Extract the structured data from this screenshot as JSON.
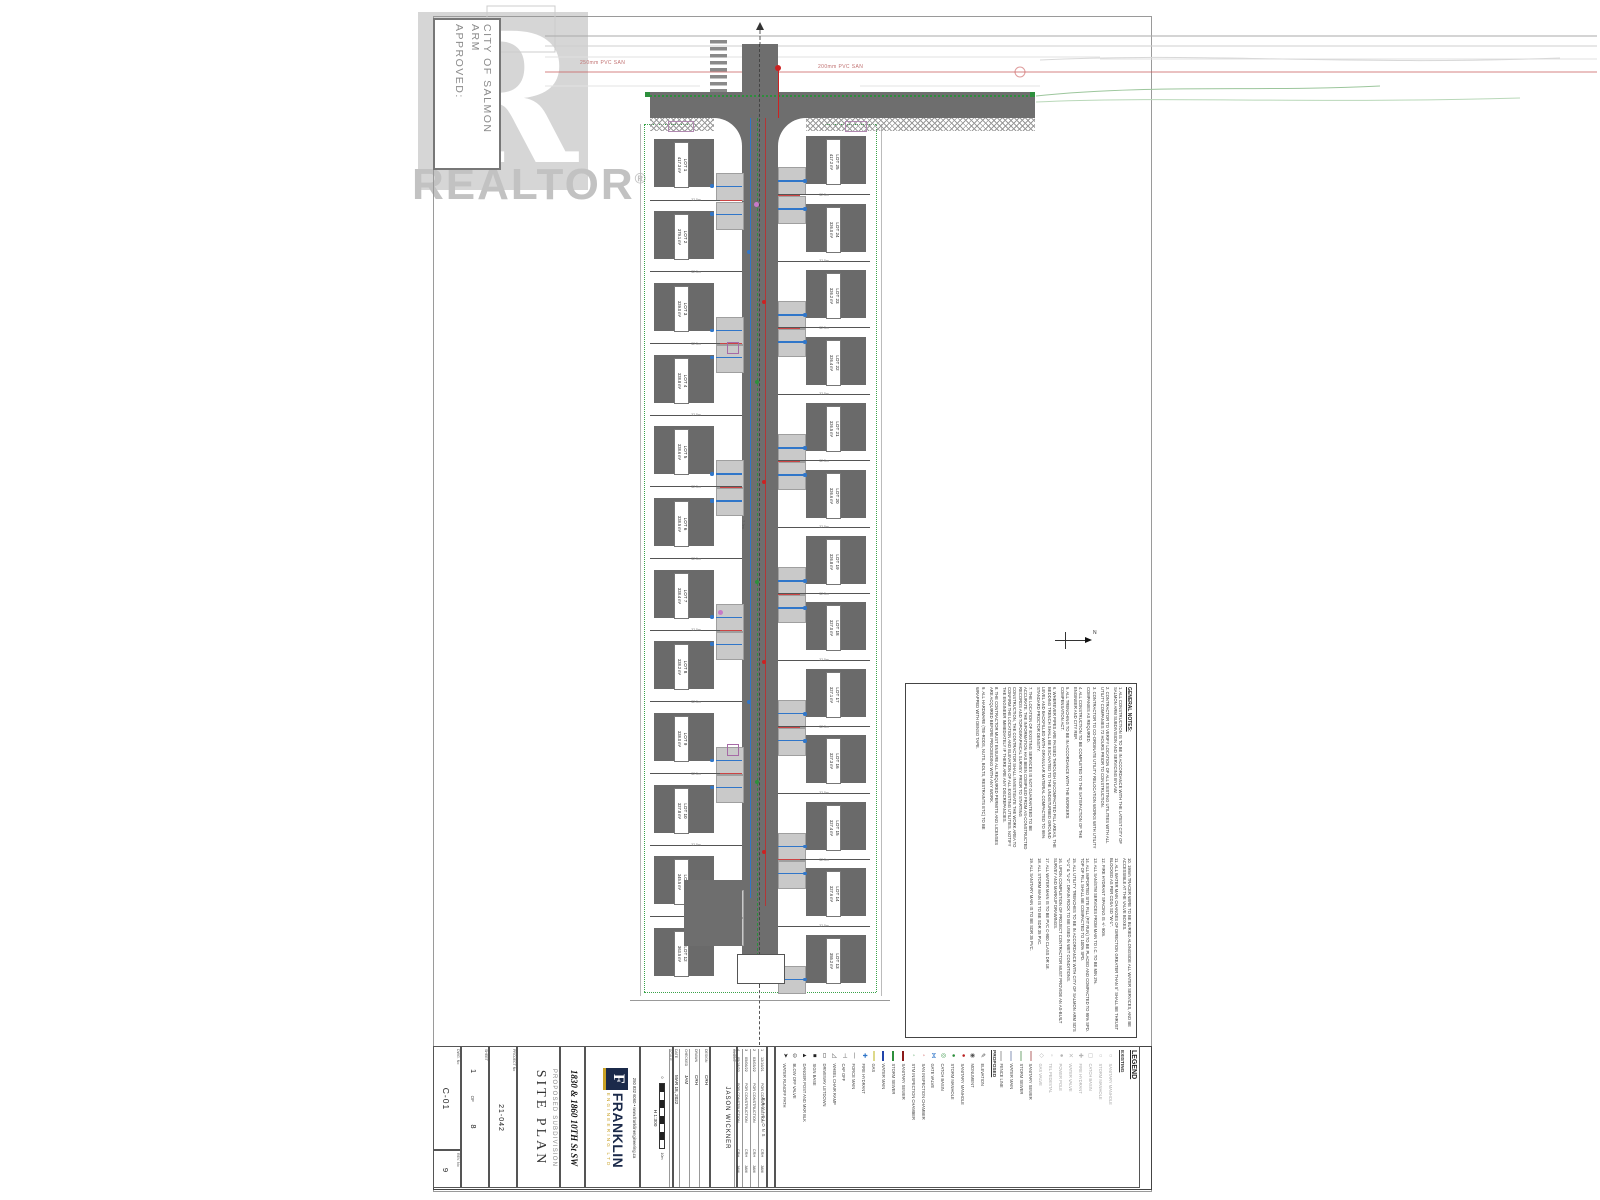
{
  "watermark": {
    "logo_letter": "R",
    "brand": "REALTOR",
    "reg": "®"
  },
  "stamp": {
    "line1": "CITY OF SALMON ARM",
    "line2": "APPROVED:"
  },
  "top_road": {
    "left_pipe_label": "250mm PVC SAN",
    "right_pipe_label": "200mm PVC SAN"
  },
  "road": {
    "width_label": "7.3m"
  },
  "north": {
    "label": "N"
  },
  "lots": {
    "left": [
      {
        "id": "LOT 1",
        "area": "417.3 m²",
        "dim": "32.5m"
      },
      {
        "id": "LOT 2",
        "area": "379.1 m²",
        "dim": "32.5m"
      },
      {
        "id": "LOT 3",
        "area": "329.0 m²",
        "dim": "32.5m"
      },
      {
        "id": "LOT 4",
        "area": "328.8 m²",
        "dim": "32.5m"
      },
      {
        "id": "LOT 5",
        "area": "328.6 m²",
        "dim": "32.5m"
      },
      {
        "id": "LOT 6",
        "area": "328.5 m²",
        "dim": "32.5m"
      },
      {
        "id": "LOT 7",
        "area": "328.4 m²",
        "dim": "32.5m"
      },
      {
        "id": "LOT 8",
        "area": "328.2 m²",
        "dim": "32.5m"
      },
      {
        "id": "LOT 9",
        "area": "328.0 m²",
        "dim": "32.5m"
      },
      {
        "id": "LOT 10",
        "area": "327.8 m²",
        "dim": "32.5m"
      },
      {
        "id": "LOT 11",
        "area": "345.5 m²",
        "dim": "32.5m"
      },
      {
        "id": "LOT 12",
        "area": "363.5 m²",
        "dim": "32.5m"
      }
    ],
    "right": [
      {
        "id": "LOT 25",
        "area": "417.2 m²",
        "dim": "32.5m"
      },
      {
        "id": "LOT 24",
        "area": "326.0 m²",
        "dim": "32.5m"
      },
      {
        "id": "LOT 23",
        "area": "326.2 m²",
        "dim": "32.5m"
      },
      {
        "id": "LOT 22",
        "area": "326.4 m²",
        "dim": "32.5m"
      },
      {
        "id": "LOT 21",
        "area": "326.5 m²",
        "dim": "32.5m"
      },
      {
        "id": "LOT 20",
        "area": "326.6 m²",
        "dim": "32.5m"
      },
      {
        "id": "LOT 19",
        "area": "326.8 m²",
        "dim": "32.5m"
      },
      {
        "id": "LOT 18",
        "area": "327.0 m²",
        "dim": "32.5m"
      },
      {
        "id": "LOT 17",
        "area": "327.1 m²",
        "dim": "32.5m"
      },
      {
        "id": "LOT 16",
        "area": "327.3 m²",
        "dim": "32.5m"
      },
      {
        "id": "LOT 15",
        "area": "327.4 m²",
        "dim": "32.5m"
      },
      {
        "id": "LOT 14",
        "area": "327.6 m²",
        "dim": "32.5m"
      },
      {
        "id": "LOT 13",
        "area": "355.2 m²",
        "dim": "32.5m"
      }
    ]
  },
  "notes": {
    "title": "GENERAL NOTES:",
    "column1": [
      "1. ALL CONSTRUCTION IS TO BE IN ACCORDANCE WITH THE LATEST CITY OF SALMON ARM SUBDIVISION AND SERVICING BYLAW.",
      "2. CONTRACTOR TO VERIFY LOCATION OF ALL EXISTING UTILITIES WITH ALL UTILITY COMPANIES 72 HOURS PRIOR TO CONSTRUCTION.",
      "3. CONTRACTOR TO CO-ORDINATE UTILITY RELOCATION WORKS WITH UTILITY COMPANIES AS REQUIRED.",
      "4. ALL CONSTRUCTION TO BE COMPLETED TO THE SATISFACTION OF THE ENGINEER AND CITY REP.",
      "5. ALL TRENCHING TO BE IN ACCORDANCE WITH THE WORKERS COMPENSATION ACT.",
      "6. WHEREVER PIPES ARE PASSED THROUGH UNCOMPACTED FILL AREAS, THE BEDDING TRENCH SHALL BE EXCAVATED TO THE UNDISTURBED GROUND LEVEL AND BACKFILLED WITH GRANULAR MATERIAL COMPACTED TO 95% STANDARD PROCTOR DENSITY.",
      "7. THE LOCATION OF EXISTING SERVICES IS NOT GUARANTEED TO BE ACCURATE. THE INFORMATION HAS BEEN COMPILED FROM AS-CONSTRUCTED RECORDS AND TOPOGRAPHICAL SURVEY. PRIOR TO STARTING CONSTRUCTION, THE CONTRACTOR SHALL INVESTIGATE THE WORK AREA TO CONFIRM THE LOCATION AND ELEVATION OF ALL EXISTING UTILITIES. NOTIFY THE ENGINEER IMMEDIATELY IF THERE ARE ANY DISCREPANCIES.",
      "8. THE CONTRACTOR MUST ENSURE ALL REQUIRED PERMITS AND LICENSES ARE ACQUIRED BEFORE PROCEEDING WITH ANY WORK.",
      "9. ALL HARDWARE (TIE-RODS, NUTS, BOLTS, RESTRAINTS ETC) TO BE WRAPPED WITH DENSO TAPE."
    ],
    "column2": [
      "10. 19mm TRACER WIRE TO BE BURIED ALONGSIDE ALL WATER SERVICES, AND BE ACCESSIBLE AT THE VALVE BOXES.",
      "11. ALL WATER MAIN CHANGES OF DIRECTION GREATER THAN 5° SHALL BE THRUST BLOCKED AS PER CDSA SD \"W-1\".",
      "12. FIRE HYDRANT SPACING IS +/- 90m.",
      "13. ALL SAN/STM SERVICES FROM MAIN TO I.C. TO BE MIN 2%.",
      "14. ALL IMPORTED SITE FILL (PIT RUN) TO BE PLACED AND COMPACTED TO 95% SPD. TOP OF FILL SHALL BE COMPACTED TO 100% SPD.",
      "15. ALL UTILITY TRENCHES TO BE IN ACCORDANCE WITH CITY OF SALMON ARM SD'S \"U-1\" & \"U-2\". DRAIN ROCK TO BE USED IN WET CONDITIONS.",
      "16. UPON COMPLETION OF PROJECT CONTRACTOR MUST PROVIDE AN AS-BUILT SURVEY AND MARKUP DRAWINGS.",
      "17. ALL WATER MAIN IS TO BE PVC C-900 CLASS DR 18.",
      "18. ALL STORM MAIN IS TO BE SDR 35 PVC.",
      "19. ALL SANITARY MAIN IS TO BE SDR 35 PVC."
    ]
  },
  "legend": {
    "items": [
      {
        "kind": "title",
        "label": "LEGEND"
      },
      {
        "kind": "header",
        "label": "EXISTING"
      },
      {
        "kind": "item",
        "label": "SANITARY MANHOLE",
        "glyph": "○",
        "color": "#b5b5b5"
      },
      {
        "kind": "item",
        "label": "STORM MANHOLE",
        "glyph": "○",
        "color": "#b5b5b5"
      },
      {
        "kind": "item",
        "label": "CATCH BASIN",
        "glyph": "◻",
        "color": "#b5b5b5"
      },
      {
        "kind": "item",
        "label": "FIRE HYDRANT",
        "glyph": "✚",
        "color": "#b5b5b5"
      },
      {
        "kind": "item",
        "label": "WATER VALVE",
        "glyph": "✕",
        "color": "#b5b5b5"
      },
      {
        "kind": "item",
        "label": "POWER POLE",
        "glyph": "●",
        "color": "#b5b5b5"
      },
      {
        "kind": "item",
        "label": "TEL PEDESTAL",
        "glyph": "▫",
        "color": "#b5b5b5"
      },
      {
        "kind": "item",
        "label": "GAS VALVE",
        "glyph": "◇",
        "color": "#b5b5b5"
      },
      {
        "kind": "line",
        "label": "SANITARY SEWER",
        "color": "#d8b2b2"
      },
      {
        "kind": "line",
        "label": "STORM SEWER",
        "color": "#b9d2b9"
      },
      {
        "kind": "line",
        "label": "WATER MAIN",
        "color": "#c2c9da"
      },
      {
        "kind": "line",
        "label": "FENCE LINE",
        "color": "#cccccc"
      },
      {
        "kind": "header",
        "label": "PROPOSED"
      },
      {
        "kind": "item",
        "label": "ELEVATION",
        "glyph": "✎",
        "color": "#555555"
      },
      {
        "kind": "item",
        "label": "MONUMENT",
        "glyph": "◉",
        "color": "#555555"
      },
      {
        "kind": "item",
        "label": "SANITARY MANHOLE",
        "glyph": "●",
        "color": "#bb2222"
      },
      {
        "kind": "item",
        "label": "STORM MANHOLE",
        "glyph": "●",
        "color": "#2d8f3c"
      },
      {
        "kind": "item",
        "label": "CATCH BASIN",
        "glyph": "◎",
        "color": "#2d8f3c"
      },
      {
        "kind": "item",
        "label": "GATE VALVE",
        "glyph": "⋈",
        "color": "#3076c9"
      },
      {
        "kind": "item",
        "label": "SAN INSPECTION CHAMBER",
        "glyph": "◦",
        "color": "#bb2222"
      },
      {
        "kind": "item",
        "label": "STM INSPECTION CHAMBER",
        "glyph": "◦",
        "color": "#2d8f3c"
      },
      {
        "kind": "line",
        "label": "SANITARY SEWER",
        "color": "#8b1a1a"
      },
      {
        "kind": "line",
        "label": "STORM SEWER",
        "color": "#2d8f3c"
      },
      {
        "kind": "line",
        "label": "WATER MAIN",
        "color": "#2244aa"
      },
      {
        "kind": "line",
        "label": "GAS",
        "color": "#ddd98a"
      },
      {
        "kind": "item",
        "label": "FIRE HYDRANT",
        "glyph": "✚",
        "color": "#3076c9"
      },
      {
        "kind": "item",
        "label": "FORCE MAIN",
        "glyph": "—",
        "color": "#555555"
      },
      {
        "kind": "item",
        "label": "CAP OFF",
        "glyph": "⊣",
        "color": "#555555"
      },
      {
        "kind": "item",
        "label": "WHEEL CHAIR RAMP",
        "glyph": "◿",
        "color": "#555555"
      },
      {
        "kind": "item",
        "label": "DRIVEWAY LETDOWN",
        "glyph": "▭",
        "color": "#333333"
      },
      {
        "kind": "item",
        "label": "SIGN BASE",
        "glyph": "■",
        "color": "#222222"
      },
      {
        "kind": "item",
        "label": "DANGER POST AND MKR BLK",
        "glyph": "▲",
        "color": "#222222"
      },
      {
        "kind": "item",
        "label": "BLOW OFF VALVE",
        "glyph": "⊖",
        "color": "#555555"
      },
      {
        "kind": "item",
        "label": "WATER RUNOFF PATH",
        "glyph": "➤",
        "color": "#222222"
      }
    ]
  },
  "titleblock": {
    "dwg_label": "DWG. No",
    "dwg_no": "C-01",
    "rev_label": "REV. No",
    "rev_no": "9",
    "sheet_label": "SHEET",
    "sheet": "1",
    "of_label": "OF",
    "sheet_total": "8",
    "project_label": "PROJECT No",
    "project_no": "21-042",
    "subtitle": "PROPOSED SUBDIVISION",
    "title": "SITE PLAN",
    "address": "1830 & 1860 10TH St SW",
    "firm": {
      "contact": "250 832 6060  •  www.franklinengineering.ca",
      "logo_letter": "F",
      "name": "FRANKLIN",
      "sub": "ENGINEERING LTD"
    },
    "scale_label": "SCALE",
    "scale": "H  1:300",
    "scale_zero": "0",
    "scale_units": "10m",
    "client_label": "CLIENT:",
    "client": "JASON WICKNER",
    "fields": [
      {
        "label": "DESIGN",
        "value": "CRH"
      },
      {
        "label": "DRAWN",
        "value": "CRH"
      },
      {
        "label": "CHECKED",
        "value": "JAM"
      },
      {
        "label": "DATE",
        "value": "MAR 18, 2022"
      }
    ],
    "revisions_header": "REVISIONS",
    "revisions": [
      {
        "no": "1",
        "date": "12/16/21",
        "desc": "FOR CONSTRUCTION",
        "dwn": "CRH",
        "ckd": "JAM"
      },
      {
        "no": "2",
        "date": "03/03/22",
        "desc": "FOR CONSTRUCTION",
        "dwn": "CRH",
        "ckd": "JAM"
      },
      {
        "no": "3",
        "date": "05/06/22",
        "desc": "FOR CONSTRUCTION",
        "dwn": "CRH",
        "ckd": "JAM"
      },
      {
        "no": "4",
        "date": "05/18/22",
        "desc": "FOR CONSTRUCTION",
        "dwn": "CRH",
        "ckd": "JAM"
      }
    ]
  }
}
